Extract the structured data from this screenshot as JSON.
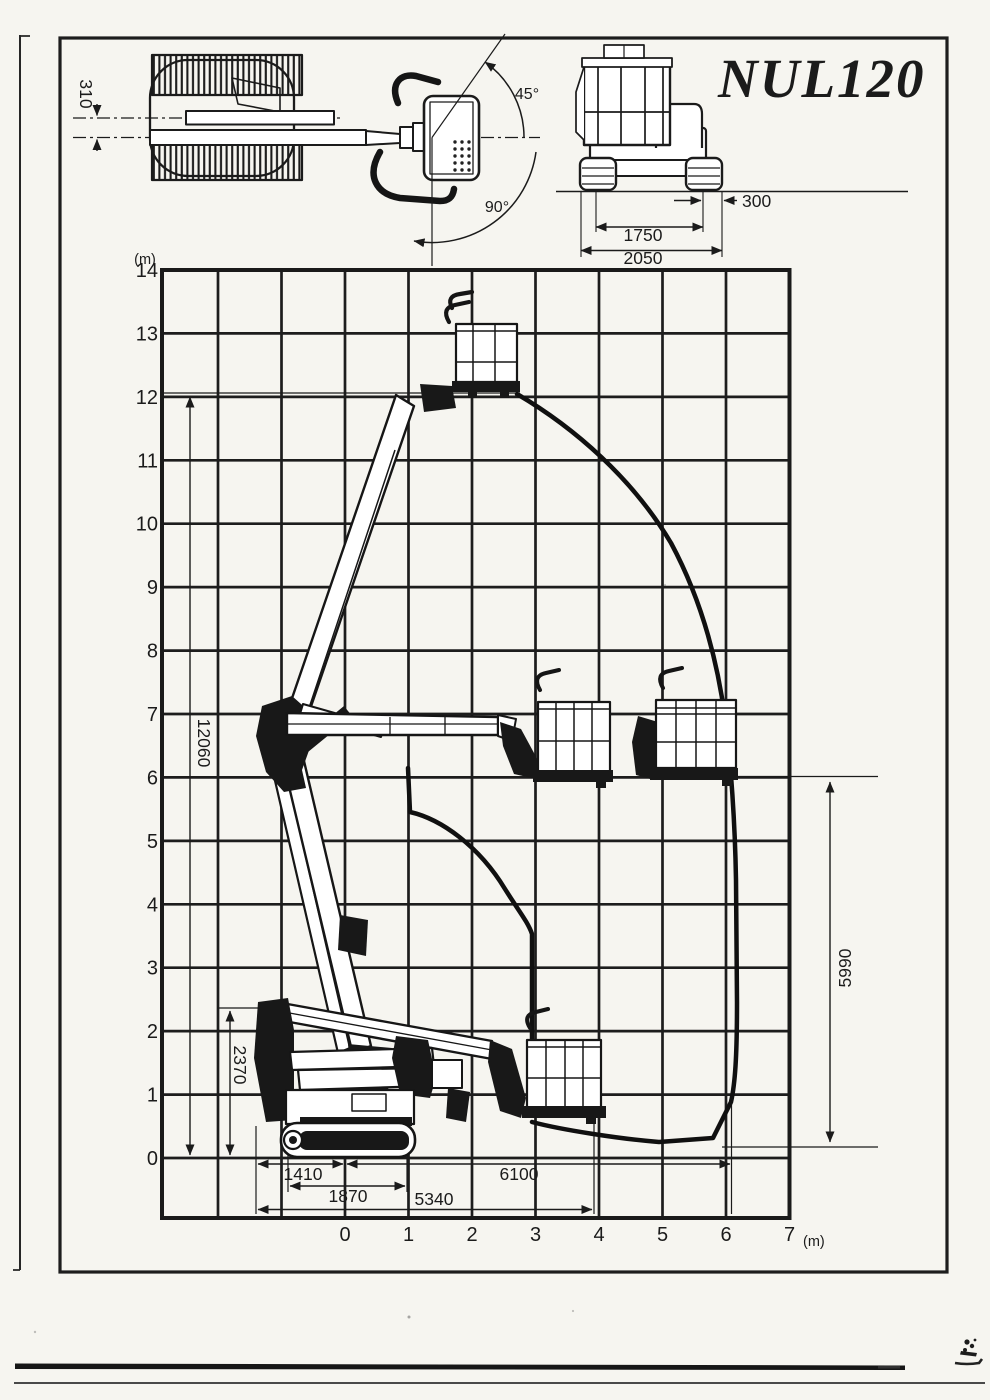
{
  "document": {
    "model": "NUL120"
  },
  "top_view": {
    "boom_offset": "310",
    "slew_angle_small": "45°",
    "slew_angle_large": "90°"
  },
  "front_view": {
    "track_shoe_width": "300",
    "track_gauge": "1750",
    "overall_width": "2050"
  },
  "range_chart": {
    "y_unit": "(m)",
    "x_unit": "(m)",
    "y_ticks": [
      "14",
      "13",
      "12",
      "11",
      "10",
      "9",
      "8",
      "7",
      "6",
      "5",
      "4",
      "3",
      "2",
      "1",
      "0"
    ],
    "x_ticks": [
      "0",
      "1",
      "2",
      "3",
      "4",
      "5",
      "6",
      "7"
    ],
    "dimensions": {
      "max_platform_height": "12060",
      "stowed_height": "2370",
      "platform_height_at_max_outreach": "5990",
      "tail_swing_radius": "1410",
      "track_length": "1870",
      "low_outreach": "5340",
      "max_outreach": "6100"
    }
  }
}
